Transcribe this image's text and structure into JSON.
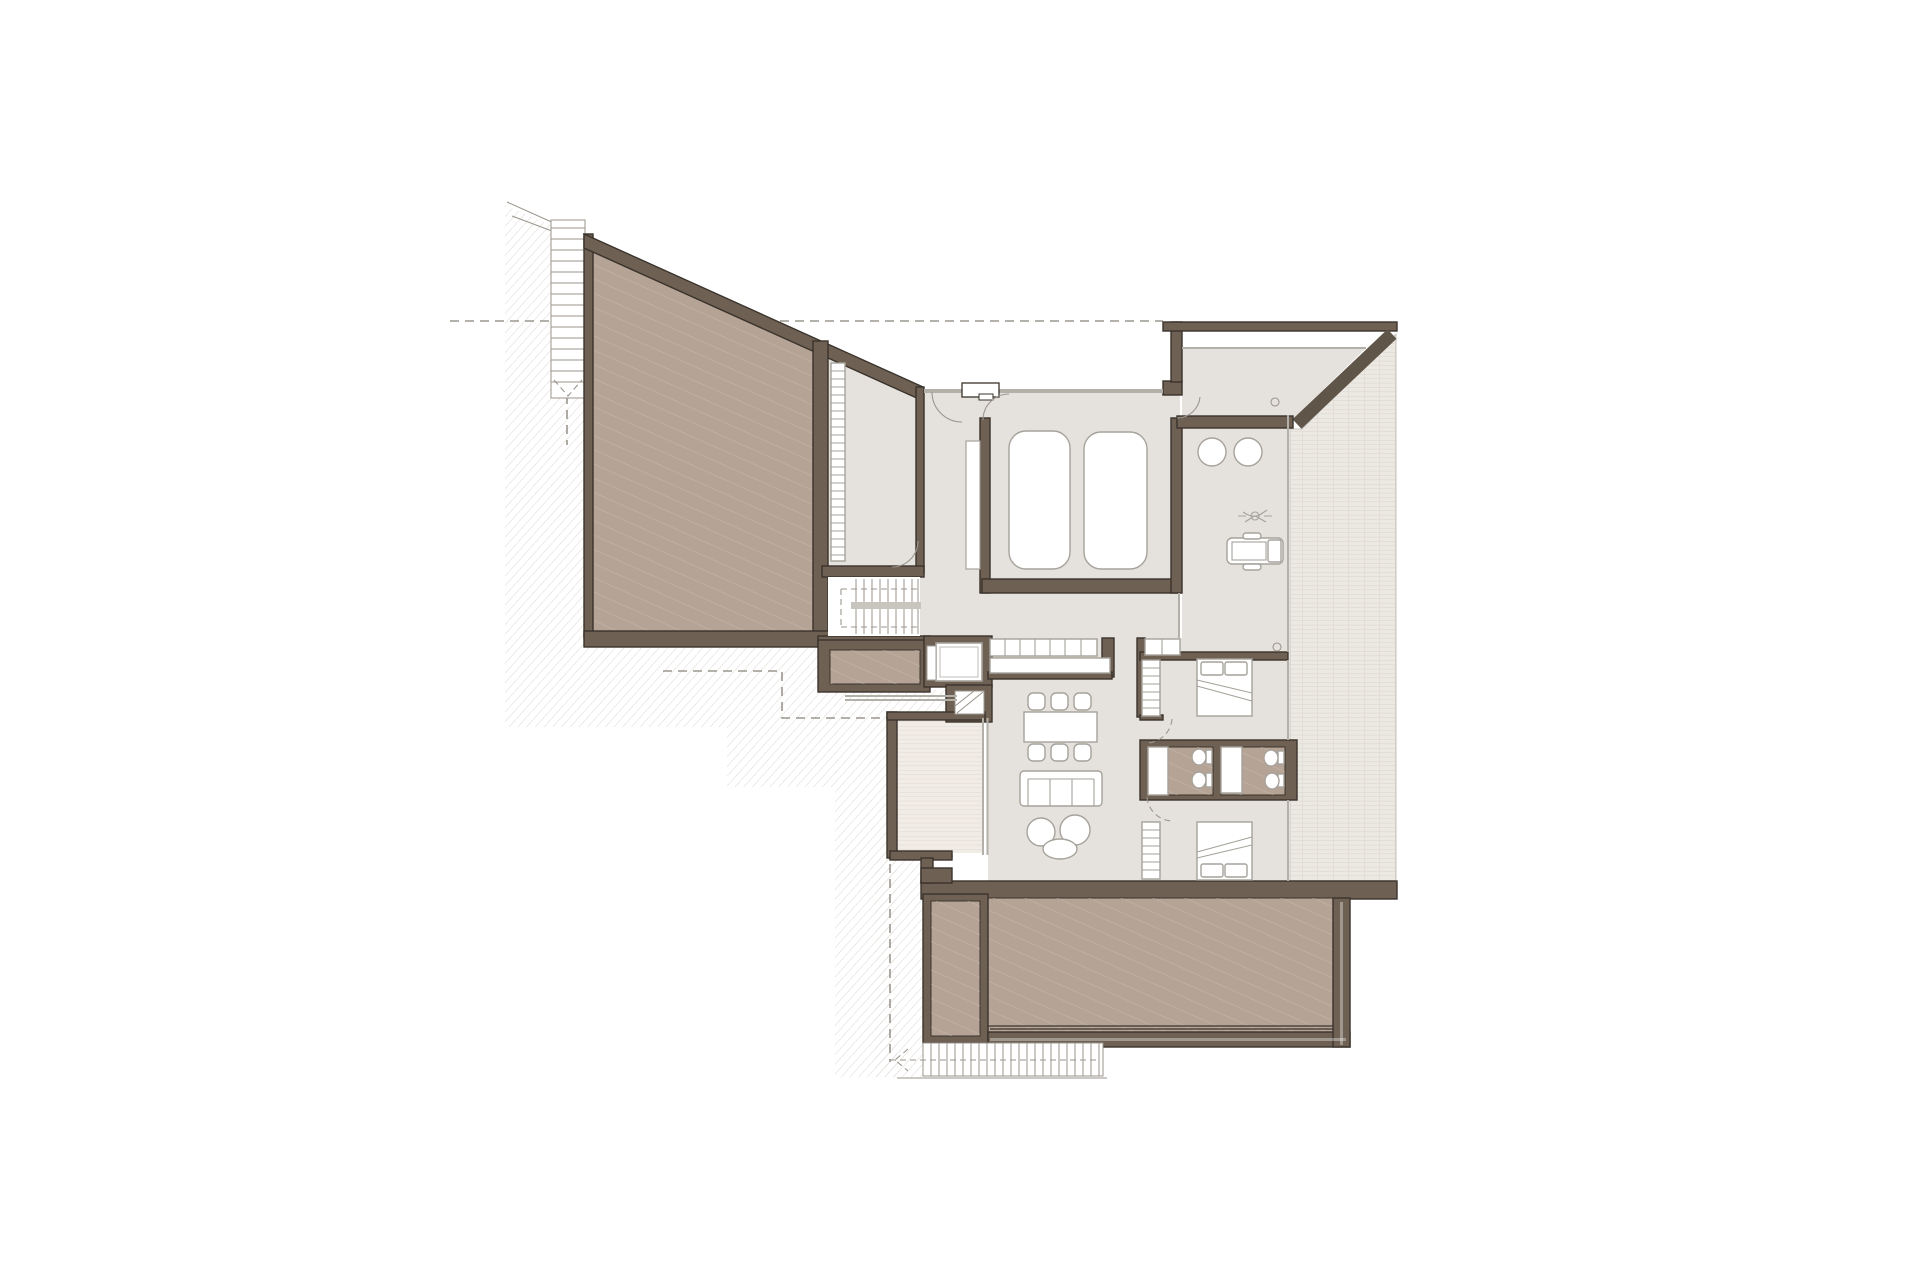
{
  "page": {
    "title": "Floor Plan"
  },
  "colors": {
    "background": "#ffffff",
    "wall_fill": "#6e6154",
    "wall_edge": "#3a332c",
    "floor": "#e5e2dd",
    "tan": "#b5a496",
    "tan_hatch_line": "#cbbeb0",
    "tile": "#ece9e3",
    "tile_line": "#d8d3cb",
    "deck": "#f1ece5",
    "deck_line": "#ded9d1",
    "terrain_line": "#dcd8d2",
    "thin_line": "#9b968e",
    "furniture_line": "#a6a29b",
    "glass_line": "#b3afa9",
    "dash_line": "#9b968e",
    "stair_rail": "#c8c4be"
  },
  "inventory": {
    "cars": 2,
    "beds": 2,
    "wash_basins": 2,
    "toilets": 4,
    "showers": 2,
    "dining_chairs": 6,
    "sofas": 1,
    "armchairs": 2,
    "stair_flights": 3,
    "elevators": 1,
    "terraces": 3
  }
}
